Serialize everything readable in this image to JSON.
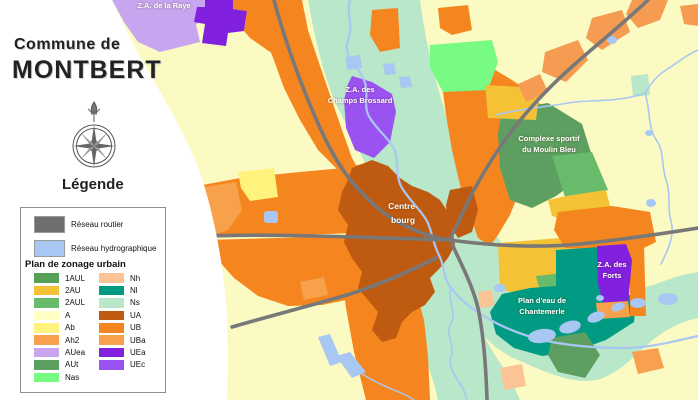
{
  "panel": {
    "title_line1": "Commune de",
    "title_line2": "MONTBERT",
    "legend_title": "Légende",
    "legend": {
      "roads_label": "Réseau routier",
      "roads_color": "#6e6e6e",
      "hydro_label": "Réseau hydrographique",
      "hydro_color": "#a9c7f3",
      "zoning_title": "Plan de zonage urbain",
      "zones_col1": [
        {
          "code": "1AUL",
          "color": "#57a057"
        },
        {
          "code": "2AU",
          "color": "#f5c235"
        },
        {
          "code": "2AUL",
          "color": "#67bb6b"
        },
        {
          "code": "A",
          "color": "#ffffc4"
        },
        {
          "code": "Ab",
          "color": "#fff27d"
        },
        {
          "code": "Ah2",
          "color": "#f7a04e"
        },
        {
          "code": "AUea",
          "color": "#c7a5ef"
        },
        {
          "code": "AUt",
          "color": "#5d9f60"
        },
        {
          "code": "Nas",
          "color": "#77fb83"
        }
      ],
      "zones_col2": [
        {
          "code": "Nh",
          "color": "#fac497"
        },
        {
          "code": "Nl",
          "color": "#009b82"
        },
        {
          "code": "Ns",
          "color": "#b9e7c9"
        },
        {
          "code": "UA",
          "color": "#bf5a11"
        },
        {
          "code": "UB",
          "color": "#f5861f"
        },
        {
          "code": "UBa",
          "color": "#f7a14b"
        },
        {
          "code": "UEa",
          "color": "#8220e0"
        },
        {
          "code": "UEc",
          "color": "#9a52f0"
        }
      ]
    }
  },
  "map": {
    "labels": {
      "za_raye": "Z.A. de la Raye",
      "za_champs_1": "Z.A. des",
      "za_champs_2": "Champs Brossard",
      "centre_1": "Centre-",
      "centre_2": "bourg",
      "complexe_1": "Complexe sportif",
      "complexe_2": "du Moulin Bleu",
      "forts_1": "Z.A. des",
      "forts_2": "Forts",
      "plan_eau_1": "Plan d'eau de",
      "plan_eau_2": "Chantemerle"
    }
  }
}
